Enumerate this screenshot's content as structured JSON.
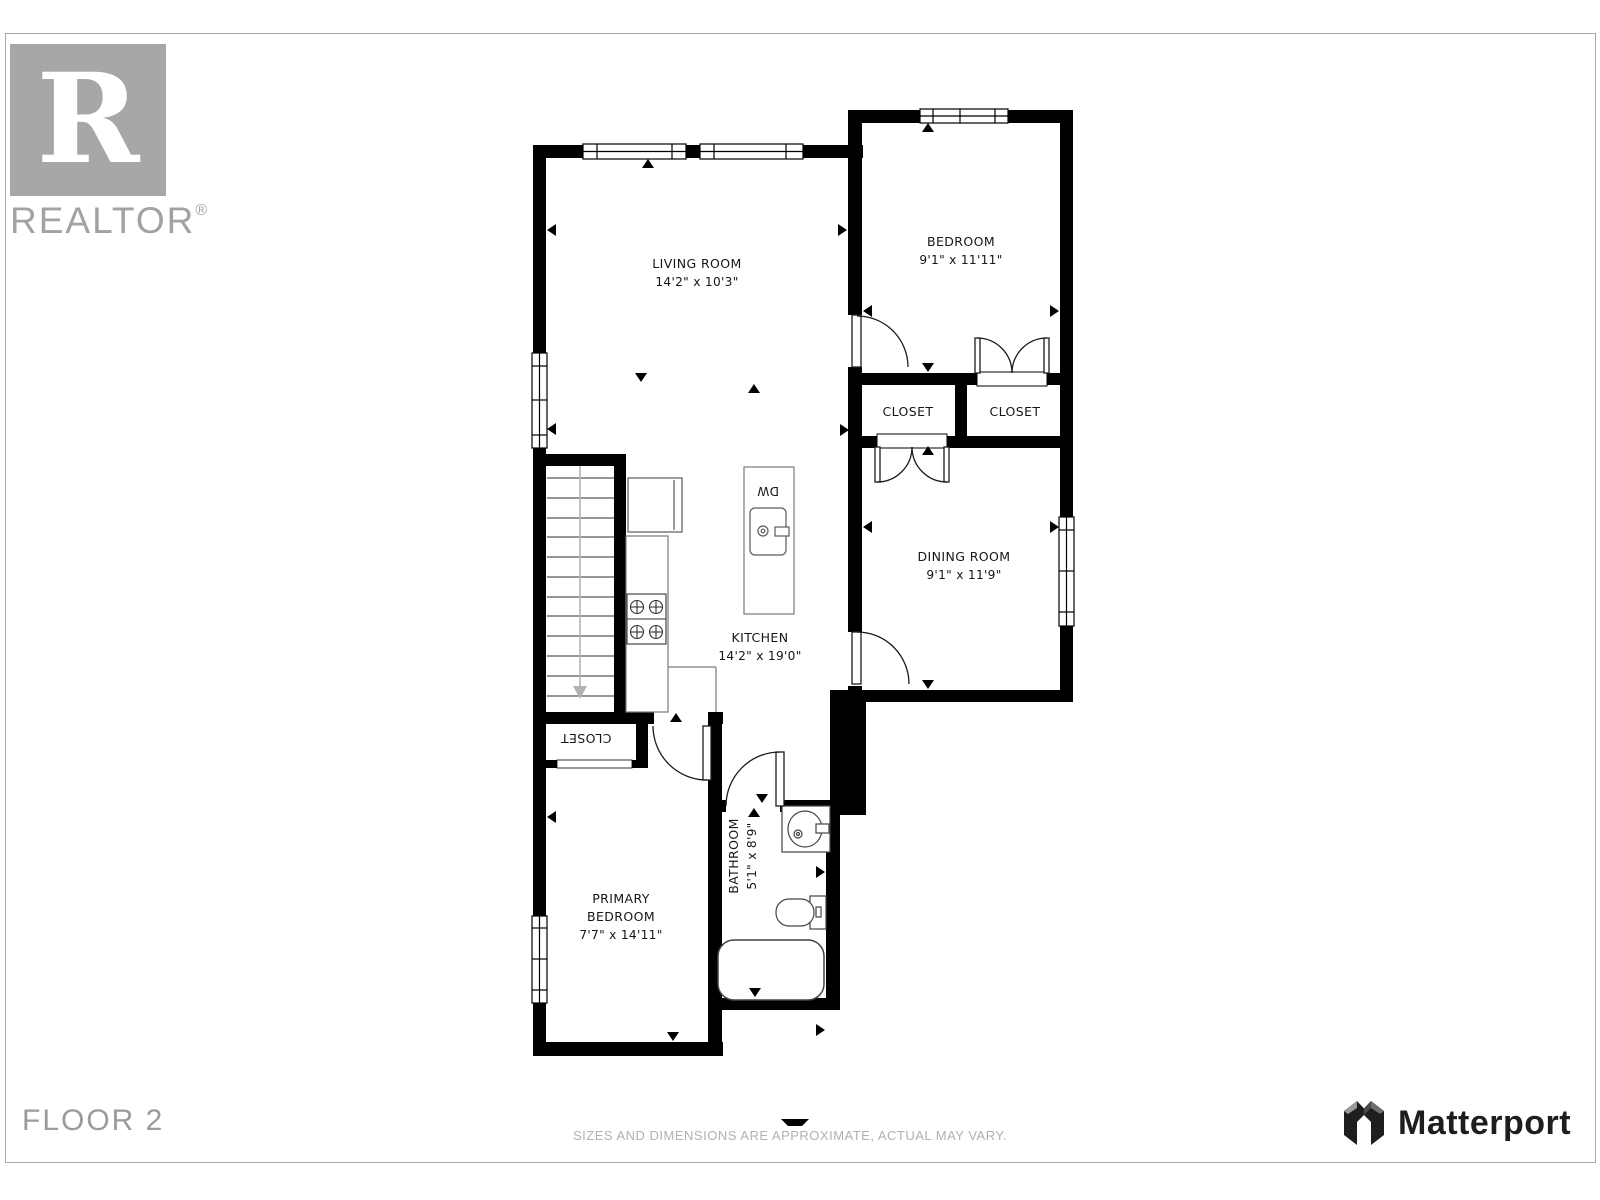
{
  "branding": {
    "realtor": {
      "letter": "R",
      "word": "REALTOR",
      "reg": "®"
    },
    "matterport": {
      "word": "Matterport"
    }
  },
  "footer": {
    "floor_label": "FLOOR 2",
    "disclaimer": "SIZES AND DIMENSIONS ARE APPROXIMATE, ACTUAL MAY VARY."
  },
  "rooms": {
    "living_room": {
      "name": "LIVING ROOM",
      "dims": "14'2\" x 10'3\""
    },
    "bedroom": {
      "name": "BEDROOM",
      "dims": "9'1\" x 11'11\""
    },
    "closet_a": {
      "name": "CLOSET"
    },
    "closet_b": {
      "name": "CLOSET"
    },
    "dining_room": {
      "name": "DINING ROOM",
      "dims": "9'1\" x 11'9\""
    },
    "kitchen": {
      "name": "KITCHEN",
      "dims": "14'2\" x 19'0\""
    },
    "closet_c": {
      "name": "CLOSET"
    },
    "primary_bedroom": {
      "line1": "PRIMARY",
      "line2": "BEDROOM",
      "dims": "7'7\" x 14'11\""
    },
    "bathroom": {
      "name": "BATHROOM",
      "dims": "5'1\" x 8'9\""
    }
  },
  "appliances": {
    "dishwasher": "DW"
  },
  "colors": {
    "wall": "#000000",
    "logo_gray": "#a7a7a7",
    "footer_gray": "#9b9b9b",
    "disclaimer_gray": "#b1b1b1",
    "matterport_dark": "#1e1e1e"
  }
}
